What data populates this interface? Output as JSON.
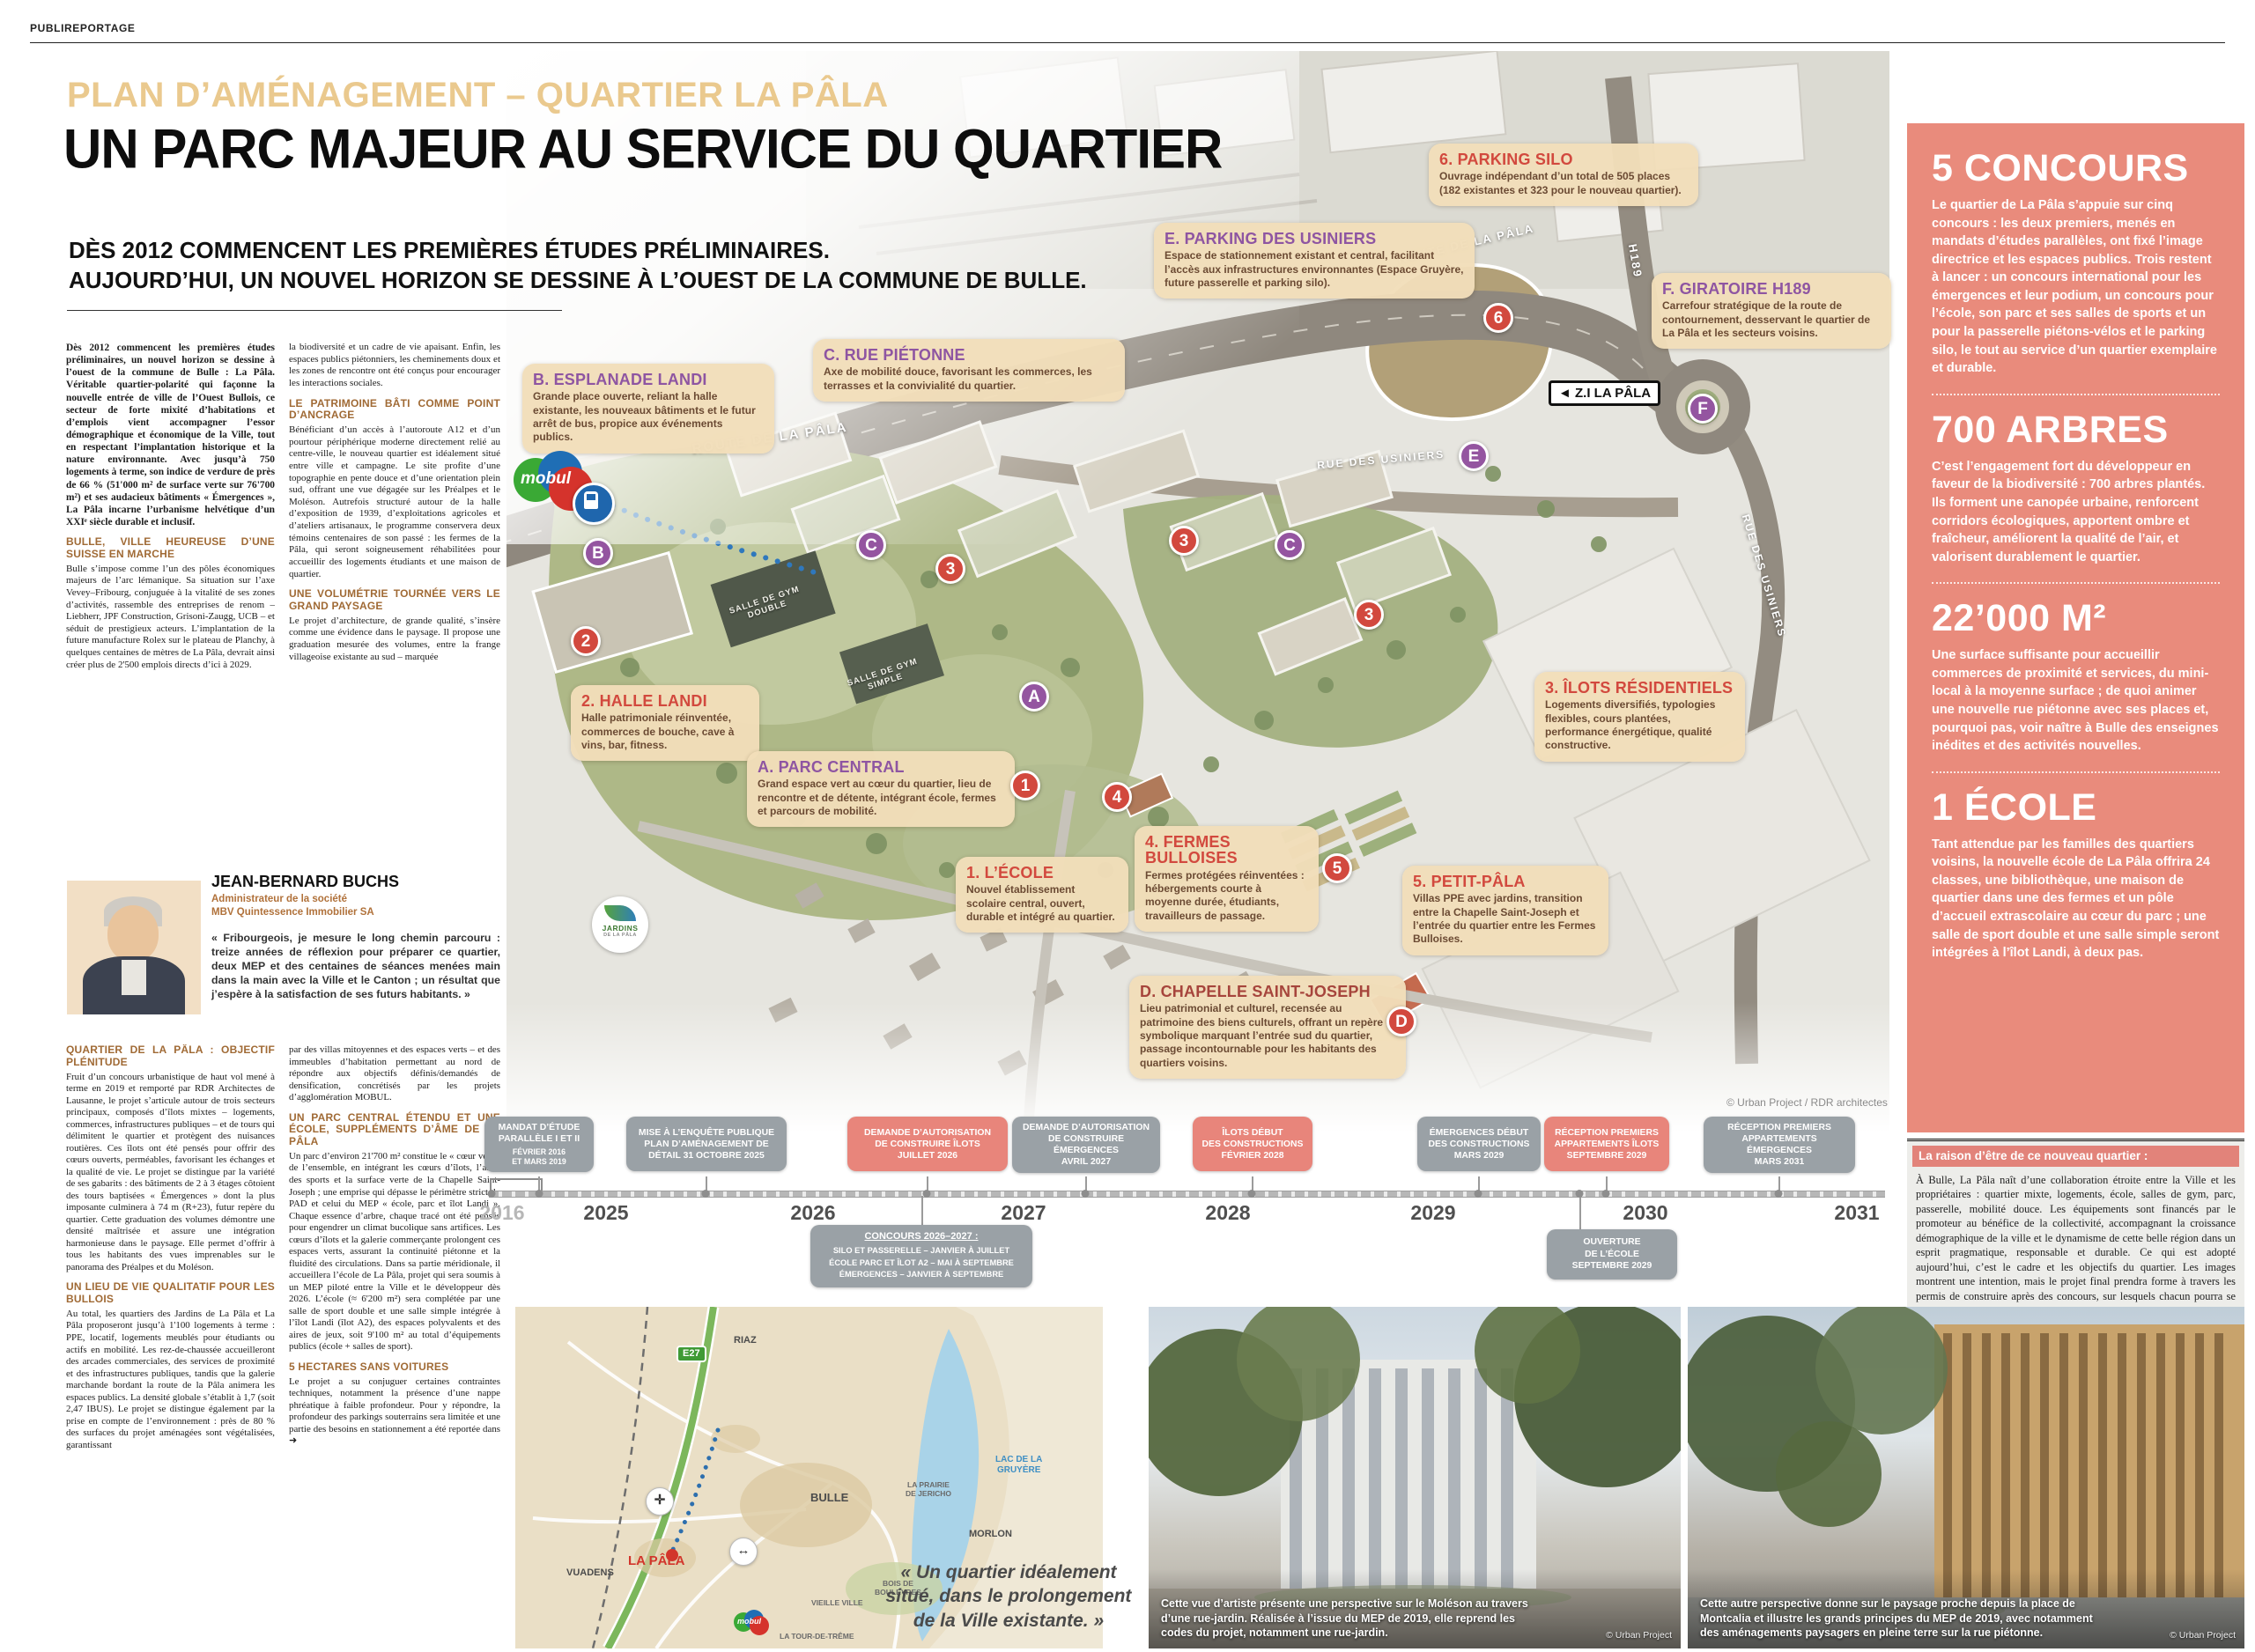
{
  "masthead": {
    "label": "PUBLIREPORTAGE"
  },
  "header": {
    "kicker": "PLAN D’AMÉNAGEMENT – QUARTIER LA PÂLA",
    "title": "UN PARC MAJEUR AU SERVICE DU QUARTIER",
    "sub1": "DÈS 2012 COMMENCENT LES PREMIÈRES ÉTUDES PRÉLIMINAIRES.",
    "sub2": "AUJOURD’HUI, UN NOUVEL HORIZON SE DESSINE À L’OUEST DE LA COMMUNE DE BULLE."
  },
  "article": {
    "intro": "Dès 2012 commencent les premières études préliminaires, un nouvel horizon se dessine à l’ouest de la commune de Bulle : La Pâla. Véritable quartier-polarité qui façonne la nouvelle entrée de ville de l’Ouest Bullois, ce secteur de forte mixité d’habitations et d’emplois vient accompagner l’essor démographique et économique de la Ville, tout en respectant l’implantation historique et la nature environnante. Avec jusqu’à 750 logements à terme, son indice de verdure de près de 66 % (51'000 m² de surface verte sur 76'700 m²) et ses audacieux bâtiments « Émergences », La Pâla incarne l’urbanisme helvétique d’un XXIᵉ siècle durable et inclusif.",
    "s1h": "BULLE, VILLE HEUREUSE D’UNE SUISSE EN MARCHE",
    "s1b": "Bulle s’impose comme l’un des pôles économiques majeurs de l’arc lémanique. Sa situation sur l’axe Vevey–Fribourg, conjuguée à la vitalité de ses zones d’activités, rassemble des entreprises de renom – Liebherr, JPF Construction, Grisoni-Zaugg, UCB – et séduit de prestigieux acteurs. L’implantation de la future manufacture Rolex sur le plateau de Planchy, à quelques centaines de mètres de La Pâla, devrait ainsi créer plus de 2'500 emplois directs d’ici à 2029.",
    "c2a": "la biodiversité et un cadre de vie apaisant. Enfin, les espaces publics piétonniers, les cheminements doux et les zones de rencontre ont été conçus pour encourager les interactions sociales.",
    "s4h": "LE PATRIMOINE BÂTI COMME POINT D’ANCRAGE",
    "s4b": "Bénéficiant d’un accès à l’autoroute A12 et d’un pourtour périphérique moderne directement relié au centre-ville, le nouveau quartier est idéalement situé entre ville et campagne. Le site profite d’une topographie en pente douce et d’une orientation plein sud, offrant une vue dégagée sur les Préalpes et le Moléson. Autrefois structuré autour de la halle d’exposition de 1939, d’exploitations agricoles et d’ateliers artisanaux, le programme conservera deux témoins centenaires de son passé : les fermes de la Pâla, qui seront soigneusement réhabilitées pour accueillir des logements étudiants et une maison de quartier.",
    "s5h": "UNE VOLUMÉTRIE TOURNÉE VERS LE GRAND PAYSAGE",
    "s5b": "Le projet d’architecture, de grande qualité, s’insère comme une évidence dans le paysage. Il propose une graduation mesurée des volumes, entre la frange villageoise existante au sud – marquée",
    "s2h": "QUARTIER DE LA PÂLA : OBJECTIF PLÉNITUDE",
    "s2b": "Fruit d’un concours urbanistique de haut vol mené à terme en 2019 et remporté par RDR Architectes de Lausanne, le projet s’articule autour de trois secteurs principaux, composés d’îlots mixtes – logements, commerces, infrastructures publiques – et de tours qui délimitent le quartier et protègent des nuisances routières. Ces îlots ont été pensés pour offrir des cœurs ouverts, perméables, favorisant les échanges et la qualité de vie. Le projet se distingue par la variété de ses gabarits : des bâtiments de 2 à 3 étages côtoient des tours baptisées « Émergences » dont la plus imposante culminera à 74 m (R+23), futur repère du quartier. Cette graduation des volumes démontre une densité maîtrisée et assure une intégration harmonieuse dans le paysage. Elle permet d’offrir à tous les habitants des vues imprenables sur le panorama des Préalpes et du Moléson.",
    "s3h": "UN LIEU DE VIE QUALITATIF POUR LES BULLOIS",
    "s3b": "Au total, les quartiers des Jardins de La Pâla et La Pâla proposeront jusqu’à 1'100 logements à terme : PPE, locatif, logements meublés pour étudiants ou actifs en mobilité. Les rez-de-chaussée accueilleront des arcades commerciales, des services de proximité et des infrastructures publiques, tandis que la galerie marchande bordant la route de la Pâla animera les espaces publics. La densité globale s’établit à 1,7 (soit 2,47 IBUS). Le projet se distingue également par la prise en compte de l’environnement : près de 80 % des surfaces du projet aménagées sont végétalisées, garantissant",
    "c2b": "par des villas mitoyennes et des espaces verts – et des immeubles d’habitation permettant au nord de répondre aux objectifs définis/demandés de densification, concrétisés par les projets d’agglomération MOBUL.",
    "s6h": "UN PARC CENTRAL ÉTENDU ET UNE ÉCOLE, SUPPLÉMENTS D’ÂME DE LA PÂLA",
    "s6b": "Un parc d’environ 21'700 m² constitue le « cœur vert » de l’ensemble, en intégrant les cœurs d’îlots, l’allée des sports et la surface verte de la Chapelle Saint-Joseph ; une emprise qui dépasse le périmètre strict du PAD et celui du MEP « école, parc et îlot Landi ». Chaque essence d’arbre, chaque tracé ont été pensés pour engendrer un climat bucolique sans artifices. Les cœurs d’îlots et la galerie commerçante prolongent ces espaces verts, assurant la continuité piétonne et la fluidité des circulations. Dans sa partie méridionale, il accueillera l’école de La Pâla, projet qui sera soumis à un MEP piloté entre la Ville et le développeur dès 2026. L’école (≈ 6'200 m²) sera complétée par une salle de sport double et une salle simple intégrée à l’îlot Landi (îlot A2), des espaces polyvalents et des aires de jeux, soit 9'100 m² au total d’équipements publics (école + salles de sport).",
    "s7h": "5 HECTARES SANS VOITURES",
    "s7b": "Le projet a su conjuguer certaines contraintes techniques, notamment la présence d’une nappe phréatique à faible profondeur. Pour y répondre, la profondeur des parkings souterrains sera limitée et une partie des besoins en stationnement a été reportée dans  ➜"
  },
  "person": {
    "name": "JEAN-BERNARD BUCHS",
    "role": "Administrateur de la société",
    "company": "MBV Quintessence Immobilier SA",
    "quote": "« Fribourgeois, je mesure le long chemin parcouru : treize années de réflexion pour préparer ce quartier, deux MEP et des centaines de séances menées main dans la main avec la Ville et le Canton ; un résultat que j’espère à la satisfaction de ses futurs habitants. »"
  },
  "map": {
    "callouts": {
      "a": {
        "title": "A. PARC CENTRAL",
        "body": "Grand espace vert au cœur du quartier, lieu de rencontre et de détente, intégrant école, fermes et parcours de mobilité."
      },
      "b": {
        "title": "B. ESPLANADE LANDI",
        "body": "Grande place ouverte, reliant la halle existante, les nouveaux bâtiments et le futur arrêt de bus, propice aux événements publics."
      },
      "c": {
        "title": "C. RUE PIÉTONNE",
        "body": "Axe de mobilité douce, favorisant les commerces, les terrasses et la convivialité du quartier."
      },
      "d": {
        "title": "D. CHAPELLE SAINT-JOSEPH",
        "body": "Lieu patrimonial et culturel, recensée au patrimoine des biens culturels, offrant un repère symbolique marquant l’entrée sud du quartier, passage incontournable pour les habitants des quartiers voisins."
      },
      "e": {
        "title": "E. PARKING DES USINIERS",
        "body": "Espace de stationnement existant et central, facilitant l’accès aux infrastructures environnantes (Espace Gruyère, future passerelle et parking silo)."
      },
      "f": {
        "title": "F. GIRATOIRE H189",
        "body": "Carrefour stratégique de la route de contournement, desservant le quartier de La Pâla et les secteurs voisins."
      },
      "n1": {
        "title": "1. L’ÉCOLE",
        "body": "Nouvel établissement scolaire central, ouvert, durable et intégré au quartier."
      },
      "n2": {
        "title": "2. HALLE LANDI",
        "body": "Halle patrimoniale réinventée, commerces de bouche, cave à vins, bar, fitness."
      },
      "n3": {
        "title": "3. ÎLOTS RÉSIDENTIELS",
        "body": "Logements diversifiés, typologies flexibles, cours plantées, performance énergétique, qualité constructive."
      },
      "n4": {
        "title": "4. FERMES BULLOISES",
        "body": "Fermes protégées réinventées : hébergements courte à moyenne durée, étudiants, travailleurs de passage."
      },
      "n5": {
        "title": "5. PETIT-PÂLA",
        "body": "Villas PPE avec jardins, transition entre la Chapelle Saint-Joseph et l’entrée du quartier entre les Fermes Bulloises."
      },
      "n6": {
        "title": "6. PARKING SILO",
        "body": "Ouvrage indépendant d’un total de 505 places (182 existantes et 323 pour le nouveau quartier)."
      }
    },
    "circles": [
      {
        "t": "B"
      },
      {
        "t": "2"
      },
      {
        "t": "C"
      },
      {
        "t": "3"
      },
      {
        "t": "3"
      },
      {
        "t": "C"
      },
      {
        "t": "3"
      },
      {
        "t": "A"
      },
      {
        "t": "1"
      },
      {
        "t": "4"
      },
      {
        "t": "5"
      },
      {
        "t": "D"
      },
      {
        "t": "E"
      },
      {
        "t": "6"
      },
      {
        "t": "F"
      }
    ],
    "roads": {
      "route1": "ROUTE DE LA PÂLA",
      "route2": "ROUTE DE LA PÂLA",
      "usiniers1": "RUE DES USINIERS",
      "usiniers2": "RUE DES USINIERS",
      "h189": "H189",
      "sign": "◄ Z.I LA PÂLA"
    },
    "gym1": "SALLE DE GYM\nDOUBLE",
    "gym2": "SALLE DE GYM\nSIMPLE",
    "logo_mobul": "mobul",
    "logo_jardins1": "JARDINS",
    "logo_jardins2": "DE LA PÂLA",
    "credit": "© Urban Project / RDR architectes"
  },
  "sidebar": {
    "stats": [
      {
        "title": "5 CONCOURS",
        "body": "Le quartier de La Pâla s’appuie sur cinq concours : les deux premiers, menés en mandats d’études parallèles, ont fixé l’image directrice et les espaces publics. Trois restent à lancer : un concours international pour les émergences et leur podium, un concours pour l’école, son parc et ses salles de sports et un pour la passerelle piétons-vélos et le parking silo, le tout au service d’un quartier exemplaire et durable."
      },
      {
        "title": "700 ARBRES",
        "body": "C’est l’engagement fort du développeur en faveur de la biodiversité : 700 arbres plantés. Ils forment une canopée urbaine, renforcent corridors écologiques, apportent ombre et fraîcheur, améliorent la qualité de l’air, et valorisent durablement le quartier."
      },
      {
        "title": "22’000 M²",
        "body": "Une surface suffisante pour accueillir commerces de proximité et services, du mini-local à la moyenne surface ; de quoi animer une nouvelle rue piétonne avec ses places et, pourquoi pas, voir naître à Bulle des enseignes inédites et des activités nouvelles."
      },
      {
        "title": "1 ÉCOLE",
        "body": "Tant attendue par les familles des quartiers voisins, la nouvelle école de La Pâla offrira 24 classes, une bibliothèque, une maison de quartier dans une des fermes et un pôle d’accueil extrascolaire au cœur du parc ; une salle de sport double et une salle simple seront intégrées à l’îlot Landi, à deux pas."
      }
    ]
  },
  "reason": {
    "title": "La raison d’être de ce nouveau quartier :",
    "body": "À Bulle, La Pâla naît d’une collaboration étroite entre la Ville et les propriétaires : quartier mixte, logements, école, salles de gym, parc, passerelle, mobilité douce. Les équipements sont financés par le promoteur au bénéfice de la collectivité, accompagnant la croissance démographique de la ville et le dynamisme de cette belle région dans un esprit pragmatique, responsable et durable. Ce qui est adopté aujourd’hui, c’est le cadre et les objectifs du quartier. Les images montrent une intention, mais le projet final prendra forme à travers les permis de construire après des concours, sur lesquels chacun pourra se prononcer."
  },
  "timeline": {
    "years": [
      "2016",
      "2025",
      "2026",
      "2027",
      "2028",
      "2029",
      "2030",
      "2031"
    ],
    "milestones": [
      {
        "label": "MANDAT D’ÉTUDE\nPARALLÈLE I ET II",
        "date": "FÉVRIER 2016\nET MARS 2019"
      },
      {
        "label": "MISE À L’ENQUÊTE PUBLIQUE\nPLAN D’AMÉNAGEMENT DE\nDÉTAIL 31 OCTOBRE 2025",
        "date": ""
      },
      {
        "label": "DEMANDE D’AUTORISATION\nDE CONSTRUIRE ÎLOTS\nJUILLET 2026",
        "date": ""
      },
      {
        "label": "DEMANDE D’AUTORISATION\nDE CONSTRUIRE ÉMERGENCES\nAVRIL 2027",
        "date": ""
      },
      {
        "label": "ÎLOTS DÉBUT\nDES CONSTRUCTIONS\nFÉVRIER 2028",
        "date": ""
      },
      {
        "label": "ÉMERGENCES DÉBUT\nDES CONSTRUCTIONS\nMARS 2029",
        "date": ""
      },
      {
        "label": "RÉCEPTION PREMIERS\nAPPARTEMENTS ÎLOTS\nSEPTEMBRE 2029",
        "date": ""
      },
      {
        "label": "RÉCEPTION PREMIERS\nAPPARTEMENTS ÉMERGENCES\nMARS 2031",
        "date": ""
      }
    ],
    "concours": {
      "title": "CONCOURS 2026–2027 :",
      "l1": "SILO ET PASSERELLE – JANVIER À JUILLET",
      "l2": "ÉCOLE PARC ET ÎLOT A2 – MAI À SEPTEMBRE",
      "l3": "ÉMERGENCES – JANVIER À SEPTEMBRE"
    },
    "ouverture": "OUVERTURE\nDE L’ÉCOLE\nSEPTEMBRE 2029"
  },
  "inset": {
    "labels": {
      "riaz": "RIAZ",
      "e27": "E27",
      "bulle": "BULLE",
      "pala": "LA PÂLA",
      "vuadens": "VUADENS",
      "morlon": "MORLON",
      "lake": "LAC DE LA\nGRUYÈRE",
      "prairie": "LA PRAIRIE\nDE JERICHO",
      "bois": "BOIS DE\nBOULEYRES",
      "vieille": "VIEILLE VILLE",
      "tour": "LA TOUR-DE-TRÊME",
      "mobul": "mobul"
    },
    "quote": "« Un quartier idéalement situé, dans le prolongement de la Ville existante. »"
  },
  "photos": [
    {
      "caption": "Cette vue d’artiste présente une perspective sur le Moléson au travers d’une rue-jardin. Réalisée à l’issue du MEP de 2019, elle reprend les codes du projet, notamment une rue-jardin.",
      "credit": "© Urban Project"
    },
    {
      "caption": "Cette autre perspective donne sur le paysage proche depuis la place de Montcalia et illustre les grands principes du MEP de 2019, avec notamment des aménagements paysagers en pleine terre sur la rue piétonne.",
      "credit": "© Urban Project"
    }
  ]
}
